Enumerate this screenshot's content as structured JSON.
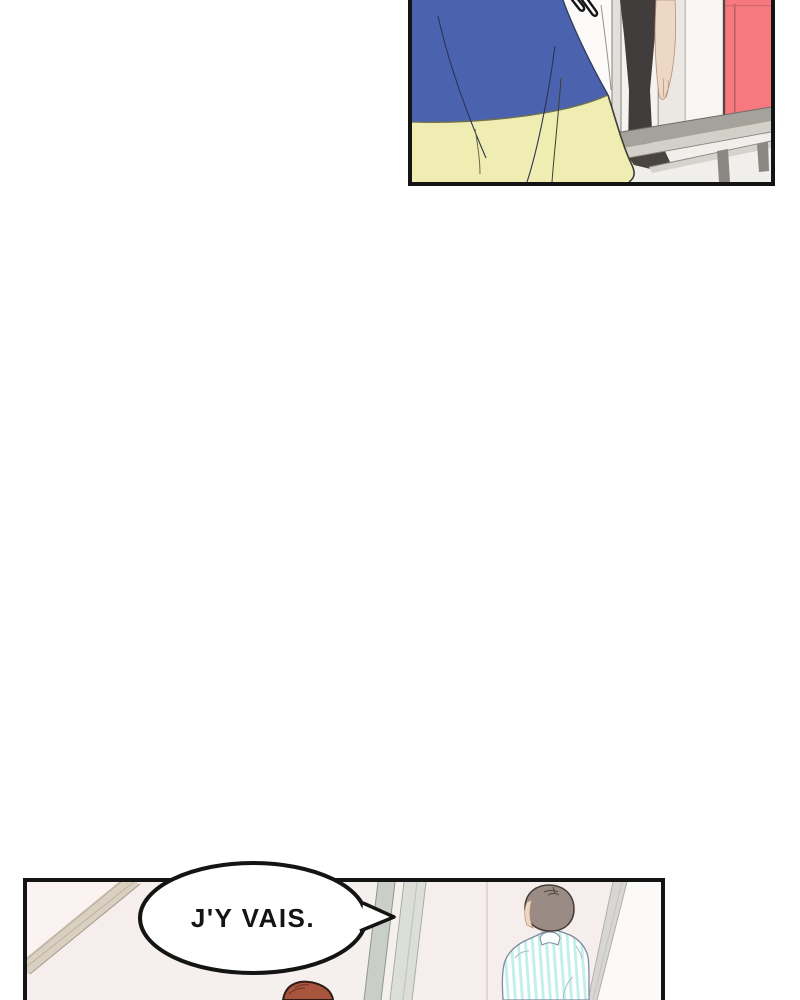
{
  "panel1": {
    "objects": [
      "blue-yellow-skirt",
      "white-shirt",
      "hairpins",
      "black-pants-leg",
      "hanging-arm",
      "red-door",
      "gray-table",
      "door-frame-wall"
    ]
  },
  "panel2": {
    "bubble_text": "J'Y VAIS.",
    "objects": [
      "speech-bubble",
      "beige-wall-frame",
      "door-frame-strips",
      "person-striped-shirt",
      "gray-hair",
      "open-door-edge",
      "red-hair-top"
    ]
  },
  "colors": {
    "page_bg": "#ffffff",
    "ink": "#141414",
    "skirt_blue": "#4b63ae",
    "skirt_yellow": "#f0edb2",
    "door_red": "#f5797e",
    "table_gray": "#a5a29c",
    "table_light": "#d3cfc9",
    "pants_dark": "#423d3d",
    "skin": "#edd8c6",
    "wall_white": "#f5f3f0",
    "wall_pink": "#f6eeed",
    "frame_beige": "#d9d0c2",
    "hair_gray": "#9a8c84",
    "shirt_stripe": "#c2eeeb",
    "hair_red": "#a9543c",
    "bubble_fill": "#ffffff"
  }
}
